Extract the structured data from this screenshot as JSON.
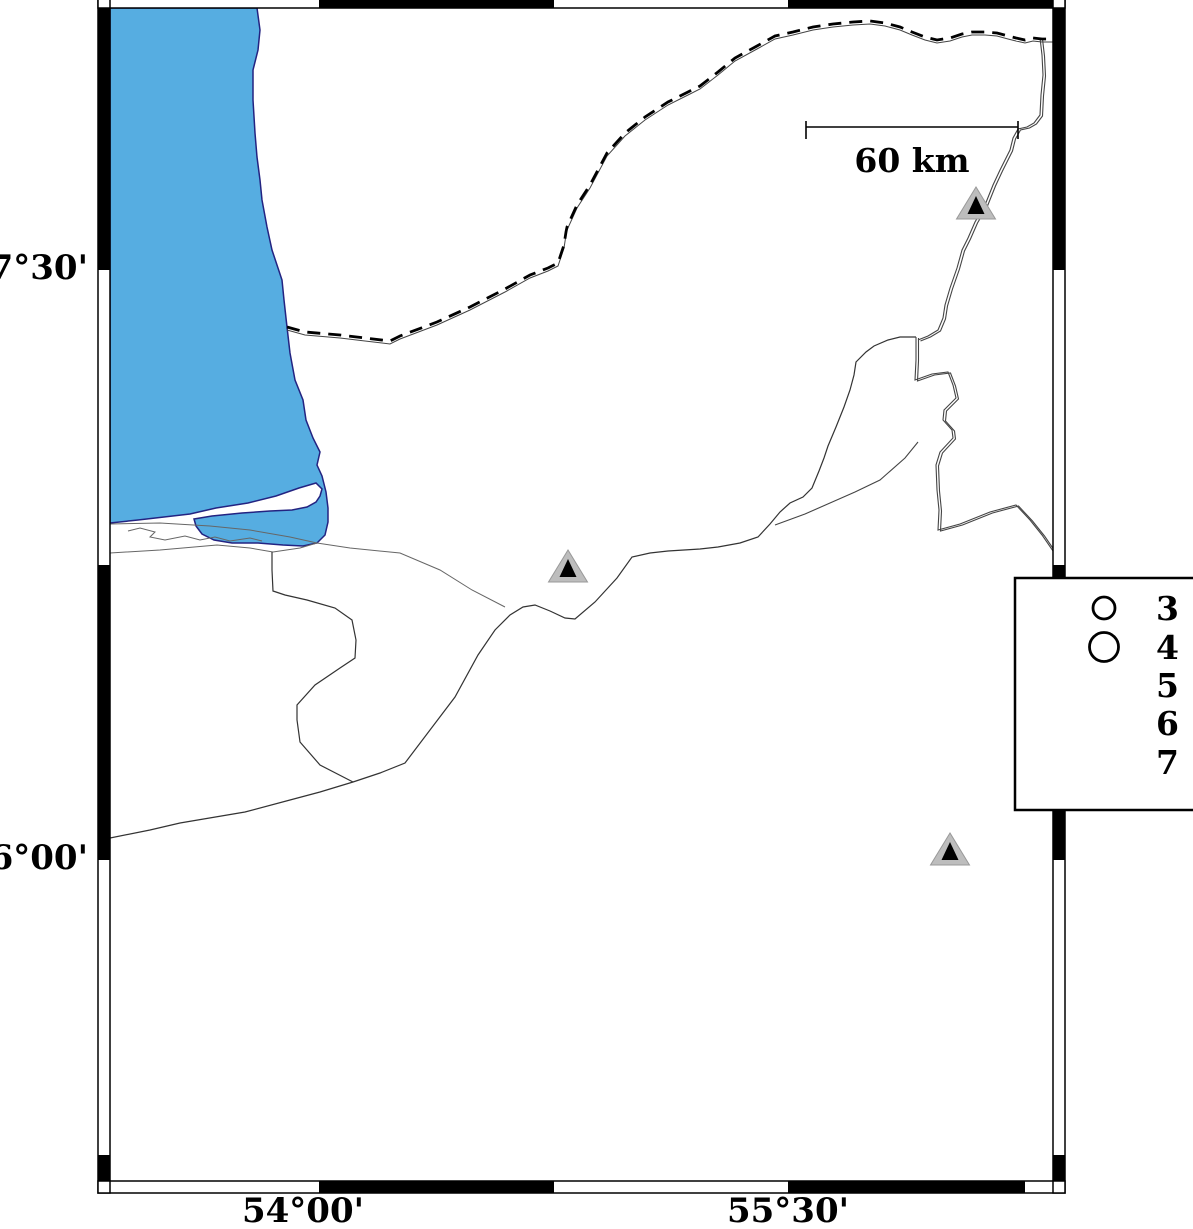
{
  "frame": {
    "lat_labels": [
      {
        "text": "37°30'"
      },
      {
        "text": "36°00'"
      }
    ],
    "lon_labels": [
      {
        "text": "54°00'"
      },
      {
        "text": "55°30'"
      }
    ]
  },
  "scale_bar": {
    "label": "60 km"
  },
  "legend": {
    "magnitude_labels": [
      "3",
      "4",
      "5",
      "6",
      "7"
    ],
    "circles": [
      {
        "label": "3",
        "radius": 11
      },
      {
        "label": "4",
        "radius": 14.5
      }
    ]
  },
  "stations": [
    {
      "x": 976,
      "y": 203
    },
    {
      "x": 568,
      "y": 566
    },
    {
      "x": 950,
      "y": 849
    }
  ],
  "colors": {
    "sea_fill": "#56ADE1",
    "sea_outline": "#232381",
    "station_fill": "#BDBDBD",
    "station_edge": "#999999",
    "station_inner": "#000000",
    "frame": "#000000",
    "thin_line": "#444444",
    "coast_detail": "#666666"
  }
}
